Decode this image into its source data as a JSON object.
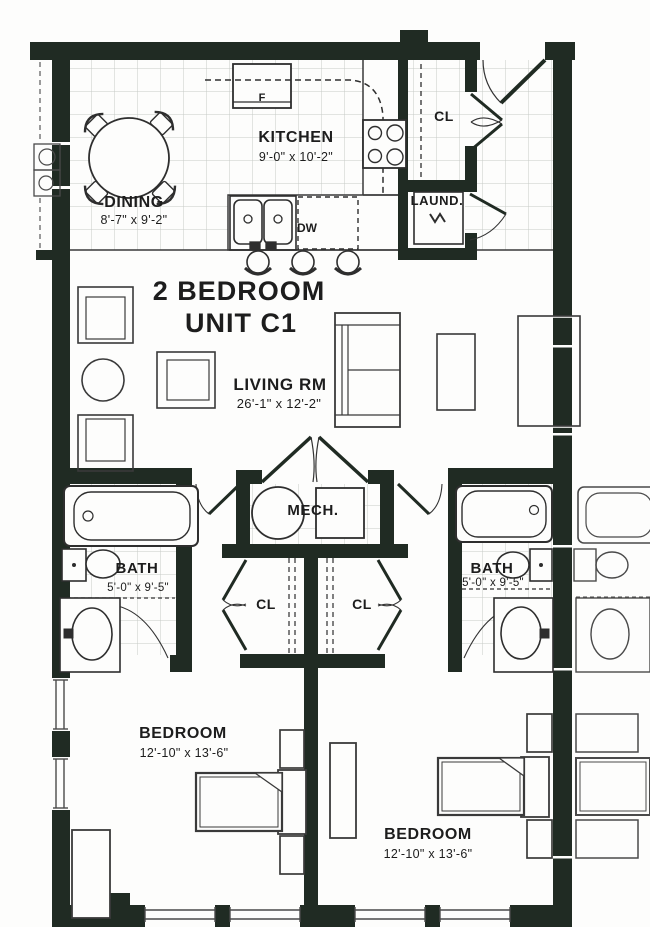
{
  "plan": {
    "unit_title": {
      "line1": "2 BEDROOM",
      "line2": "UNIT C1"
    },
    "rooms": {
      "kitchen": {
        "label": "KITCHEN",
        "dims": "9'-0\" x 10'-2\""
      },
      "dining": {
        "label": "DINING",
        "dims": "8'-7\" x 9'-2\""
      },
      "living": {
        "label": "LIVING RM",
        "dims": "26'-1\" x 12'-2\""
      },
      "laundry": {
        "label": "LAUND."
      },
      "mech": {
        "label": "MECH."
      },
      "entry_closet": {
        "label": "CL"
      },
      "closet_left": {
        "label": "CL"
      },
      "closet_right": {
        "label": "CL"
      },
      "bath_left": {
        "label": "BATH",
        "dims": "5'-0\" x 9'-5\""
      },
      "bath_right": {
        "label": "BATH",
        "dims": "5'-0\" x 9'-5\""
      },
      "bedroom_left": {
        "label": "BEDROOM",
        "dims": "12'-10\" x 13'-6\""
      },
      "bedroom_right": {
        "label": "BEDROOM",
        "dims": "12'-10\" x 13'-6\""
      }
    },
    "appliances": {
      "fridge": "F",
      "dishwasher": "DW"
    },
    "colors": {
      "wall": "#202b23",
      "fixture_line": "#2e2e2e",
      "tile_line": "#c6cac6",
      "text": "#1d1d1d",
      "paper": "#fdfdfc"
    }
  }
}
